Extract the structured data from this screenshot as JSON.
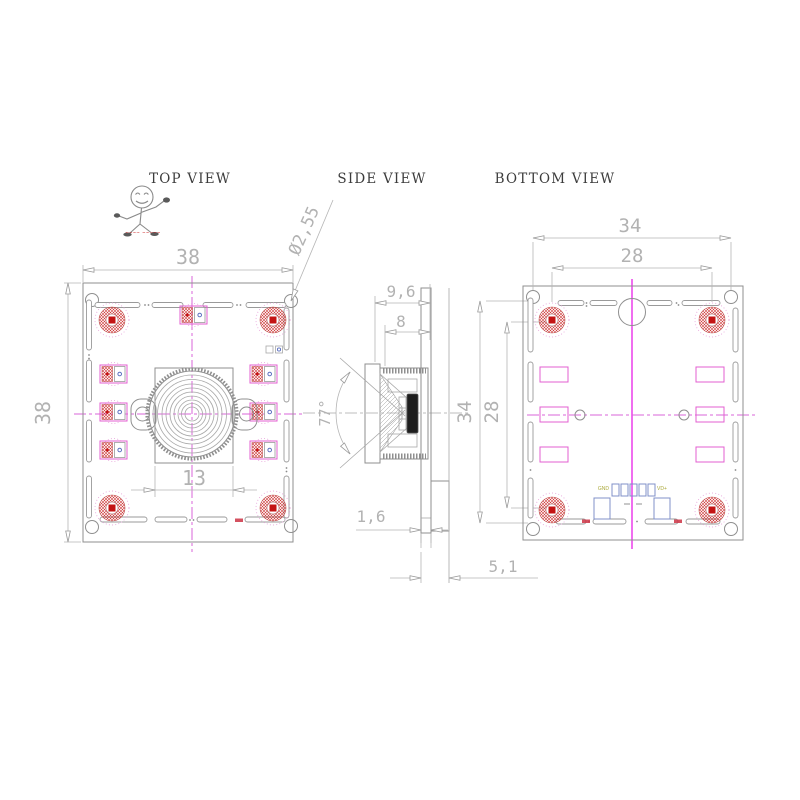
{
  "document": {
    "background": "#ffffff",
    "type": "camera-module-technical-drawing"
  },
  "view_labels": {
    "top": "TOP VIEW",
    "side": "SIDE VIEW",
    "bottom": "BOTTOM VIEW"
  },
  "logo": {
    "caption": "~~~~ ~~~~~"
  },
  "dimensions": {
    "top_view": {
      "width": "38",
      "height": "38",
      "lens_base": "13",
      "hole_dia": "Ø2,55"
    },
    "side_view": {
      "depth_total": "9,6",
      "depth_lens": "8",
      "fov": "77°",
      "pcb_thickness": "1,6",
      "rear_height": "5,1"
    },
    "bottom_view": {
      "corner_span_h": "34",
      "hole_span_h": "28",
      "corner_span_v": "34",
      "hole_span_v": "28"
    }
  },
  "silkscreen": {
    "gnd": "GND",
    "vcc": "VD+"
  },
  "colors": {
    "centerline": "#ee55ee",
    "pad_red": "#c41414",
    "pad_blue": "#8090c8",
    "line_gray": "#9a9a9a",
    "dim_gray": "#b2b2b2",
    "silkscreen_olive": "#aaa838",
    "logo_red": "#cc2222"
  }
}
